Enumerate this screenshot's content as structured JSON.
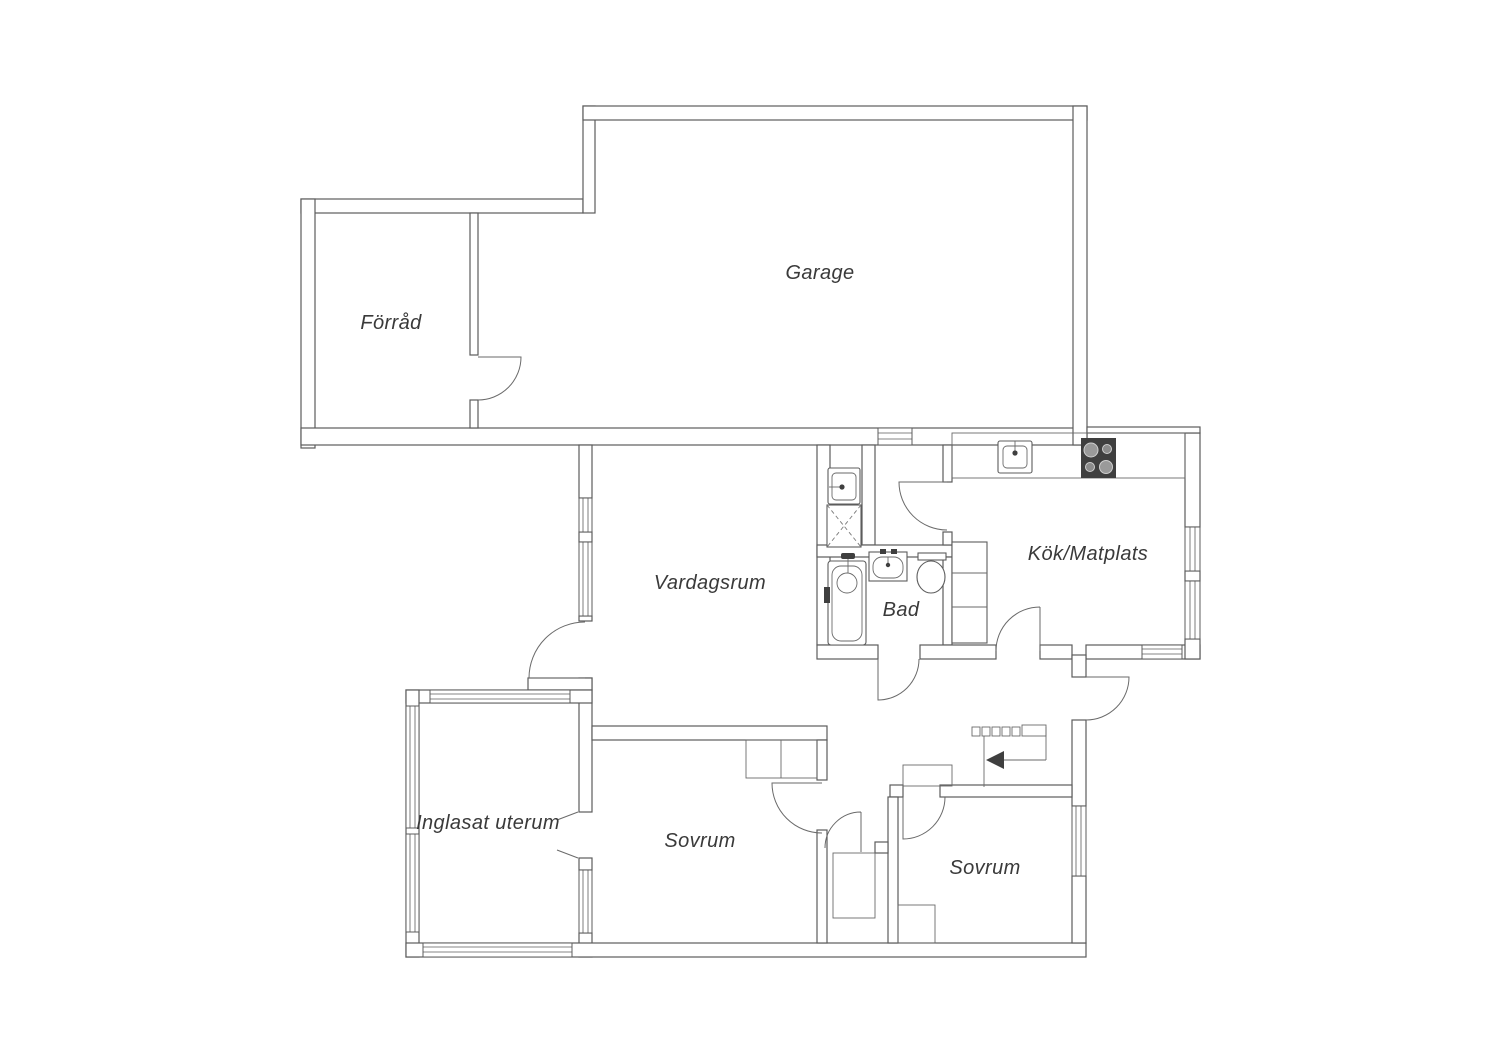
{
  "plan": {
    "type": "floorplan",
    "language": "Swedish",
    "rooms": {
      "garage": {
        "label": "Garage"
      },
      "forrad": {
        "label": "Förråd"
      },
      "vardagsrum": {
        "label": "Vardagsrum"
      },
      "kok": {
        "label": "Kök/Matplats"
      },
      "bad": {
        "label": "Bad"
      },
      "sovrum1": {
        "label": "Sovrum"
      },
      "sovrum2": {
        "label": "Sovrum"
      },
      "uterum": {
        "label": "Inglasat uterum"
      }
    },
    "icons": {
      "stove-icon": "dark square with 4 round burners",
      "kitchen-sink-icon": "double rectangle with faucet dot",
      "laundry-sink-icon": "square basin with faucet dot",
      "shower-icon": "square with dashed X",
      "bathtub-icon": "rounded rectangle with drain circle",
      "washbasin-icon": "rectangle with inner bowl and taps",
      "toilet-icon": "oval bowl with tank bar",
      "stairs-icon": "row of steps with left direction arrow",
      "window-icon": "striped bar in wall",
      "door-icon": "quarter-circle swing arc"
    },
    "colors": {
      "background": "#ffffff",
      "wall_line": "#5c5c5c",
      "stove_fill": "#3f3f3f",
      "label_text": "#3a3a3a"
    }
  }
}
